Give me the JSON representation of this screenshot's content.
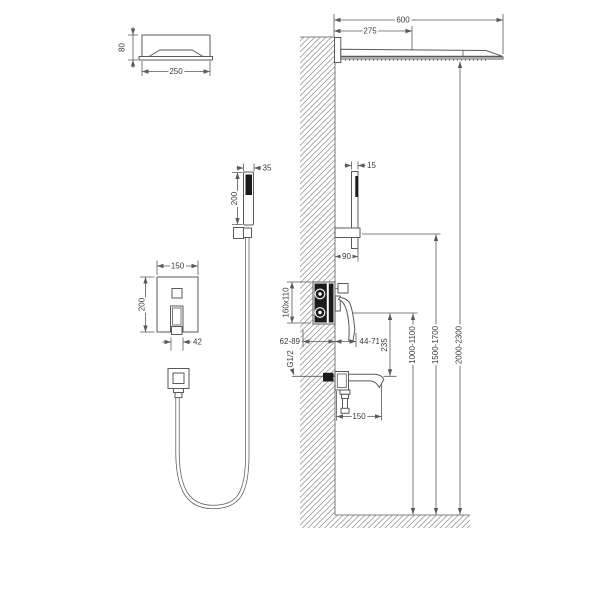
{
  "meta": {
    "description": "Concealed wall-mounted shower system installation diagram, dimensions in mm"
  },
  "colors": {
    "line": "#5a5a5a",
    "text": "#3b3b3b",
    "dark_fill": "#1b1b1b",
    "hatch": "#909090",
    "background": "#ffffff"
  },
  "dims": {
    "head_front_height": "80",
    "head_front_width": "250",
    "head_side_length": "600",
    "head_side_center": "275",
    "hand_front_width": "35",
    "hand_front_length": "200",
    "hand_side_width": "15",
    "holder_depth": "90",
    "mixer_width": "150",
    "mixer_height": "200",
    "mixer_handle": "42",
    "valve_recess": "160x110",
    "valve_depth": "62-89",
    "valve_handle": "44-71",
    "valve_thread": "G1/2",
    "valve_spout_gap": "235",
    "mixer_install_height": "1000-1100",
    "holder_install_height": "1500-1700",
    "head_install_height": "2000-2300",
    "spout_length": "150"
  }
}
